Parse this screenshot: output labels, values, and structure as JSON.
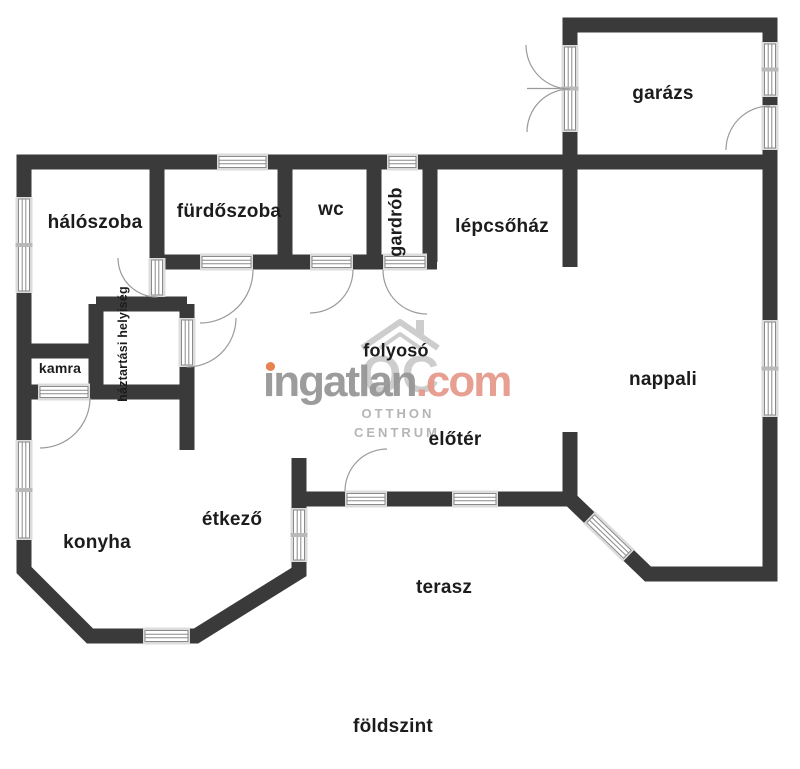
{
  "colors": {
    "wall": "#3a3a3a",
    "opening_band": "#dcdcdc",
    "frame_line": "#8a8a8a",
    "swing_arc": "#9a9a9a",
    "label_text": "#1c1c1c",
    "watermark_gray": "#979797",
    "watermark_salmon": "#e59a8b",
    "watermark_light_gray": "#c8c8c8",
    "watermark_dot_orange": "#e8824f"
  },
  "rooms": {
    "haloszoba": {
      "label": "hálószoba"
    },
    "furdoszoba": {
      "label": "fürdőszoba"
    },
    "wc": {
      "label": "wc"
    },
    "gardrob": {
      "label": "gardrób"
    },
    "lepcsohaz": {
      "label": "lépcsőház"
    },
    "garazs": {
      "label": "garázs"
    },
    "nappali": {
      "label": "nappali"
    },
    "folyoso": {
      "label": "folyosó"
    },
    "eloter": {
      "label": "előtér"
    },
    "haztartasi": {
      "label": "háztartási helyiség"
    },
    "kamra": {
      "label": "kamra"
    },
    "konyha": {
      "label": "konyha"
    },
    "etkezo": {
      "label": "étkező"
    },
    "terasz": {
      "label": "terasz"
    }
  },
  "floor": {
    "label": "földszint"
  },
  "watermark": {
    "brand": "ingatlan",
    "tld": ".com",
    "logo_monogram": "OC",
    "line1": "OTTHON",
    "line2": "CENTRUM"
  }
}
